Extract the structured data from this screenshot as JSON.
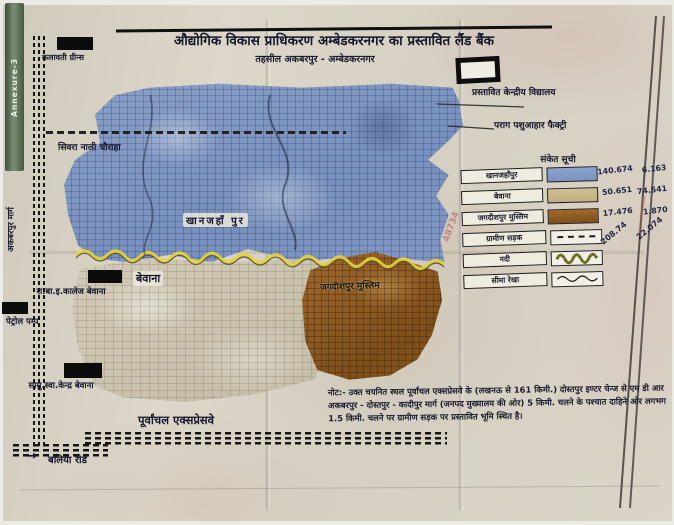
{
  "annexure": {
    "label": "Annexure-3"
  },
  "header": {
    "title": "औद्योगिक विकास प्राधिकरण अम्बेडकरनगर का प्रस्तावित लैंड बैंक",
    "subtitle": "तहसील अकबरपुर - अम्बेडकरनगर"
  },
  "map": {
    "labels": {
      "kalawati_greens": "कलावती ग्रीन्स",
      "siwara_nali_chauraha": "सिवरा नाली चौराहा",
      "akbarpur_marg": "अकबरपुर मार्ग",
      "khanjahanpur": "खानजहाँ पुर",
      "bewana": "बेवाना",
      "jagdishpur_muslim": "जगदीशपुर मुस्लिम",
      "college_bewana": "रा.बा.इ.कालेज बेवाना",
      "petrol_pump": "पेट्रोल पम्प",
      "health_centre_bewana": "सामु.स्वा.केन्द्र बेवाना",
      "purvanchal_expressway": "पूर्वांचल एक्सप्रेसवे",
      "ballia_road": "बलिया रोड",
      "arrow": "→",
      "proposed_kendriya_vidyalaya": "प्रस्तावित केन्द्रीय विद्यालय",
      "parag_factory": "पराग पशुआहार फैक्ट्री",
      "handwritten_number": "48734"
    },
    "region_colors": {
      "khanjahanpur_blue": "#7e97c2",
      "bewana_tan": "#cdc5b2",
      "jagdishpur_brown": "#96622d",
      "boundary_yellow": "#e6d33c"
    }
  },
  "legend": {
    "title": "संकेत सूची",
    "rows": [
      {
        "label": "खानजहाँपुर",
        "symbol": "blue-swatch",
        "style": "background:linear-gradient(180deg,#8ba4ce,#7b93bf)",
        "v1": "140.674",
        "v2": "6.163"
      },
      {
        "label": "बेवाना",
        "symbol": "tan-swatch",
        "style": "background:linear-gradient(180deg,#cfc194,#bfaf82)",
        "v1": "50.651",
        "v2": "74.541"
      },
      {
        "label": "जगदीशपुर मुस्लिम",
        "symbol": "brown-swatch",
        "style": "background:linear-gradient(180deg,#a06a2a,#7d4d1b)",
        "v1": "17.476",
        "v2": "1.870"
      },
      {
        "label": "ग्रामीण सड़क",
        "symbol": "dashed-road-line",
        "v1": "208.74",
        "v2": "22.074"
      },
      {
        "label": "नदी",
        "symbol": "river-wave-line",
        "v1": "",
        "v2": ""
      },
      {
        "label": "सीमा रेखा",
        "symbol": "boundary-wave-line",
        "v1": "",
        "v2": ""
      }
    ]
  },
  "note": {
    "text": "नोट:- उक्त चयनित स्थल पूर्वांचल एक्सप्रेसवे के (लखनऊ से 161 किमी.) दोस्तपुर इण्टर चेन्ज से एम डी आर अकबरपुर - दोस्तपुर - कादीपुर मार्ग (जनपद मुख्यालय की ओर) 5 किमी. चलने के पश्चात दाहिने ओर लगभग 1.5 किमी. चलने पर ग्रामीण सड़क पर प्रस्तावित भूमि स्थित है।"
  }
}
